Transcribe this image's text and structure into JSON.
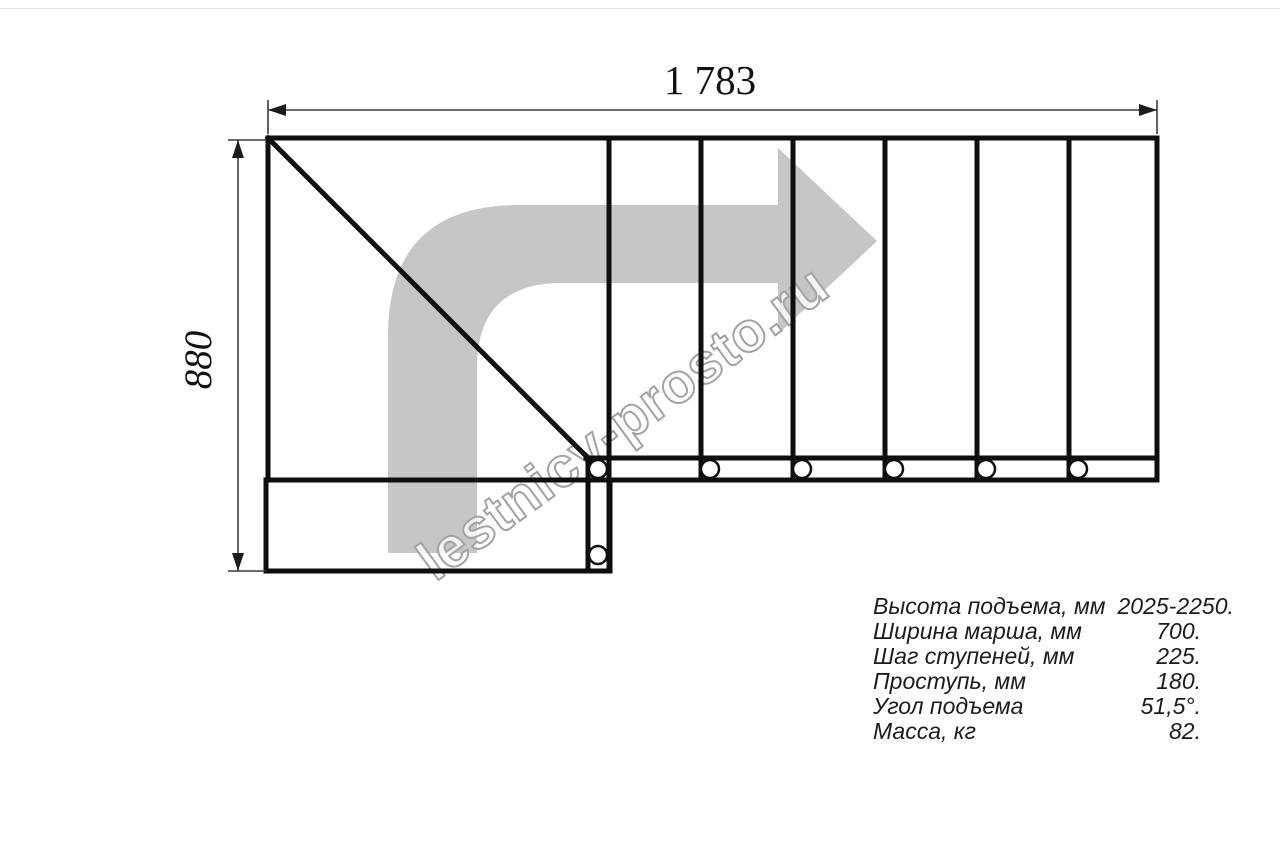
{
  "drawing": {
    "top_dimension_label": "1 783",
    "left_dimension_label": "880",
    "watermark_text": "lestnicy-prosto.ru"
  },
  "specs": {
    "rows": [
      {
        "label": "Высота подъема, мм",
        "value": "2025-2250."
      },
      {
        "label": "Ширина марша, мм",
        "value": "700."
      },
      {
        "label": "Шаг ступеней, мм",
        "value": "225."
      },
      {
        "label": "Проступь, мм",
        "value": "180."
      },
      {
        "label": "Угол подъема",
        "value": "51,5°."
      },
      {
        "label": "Масса, кг",
        "value": "82."
      }
    ]
  },
  "colors": {
    "structure_line": "#0e0e0e",
    "dimension_line": "#3c3c3c",
    "arrow_fill": "#c6c6c6",
    "watermark_outline": "#a3a3a3",
    "table_text": "#1b1b1b"
  }
}
